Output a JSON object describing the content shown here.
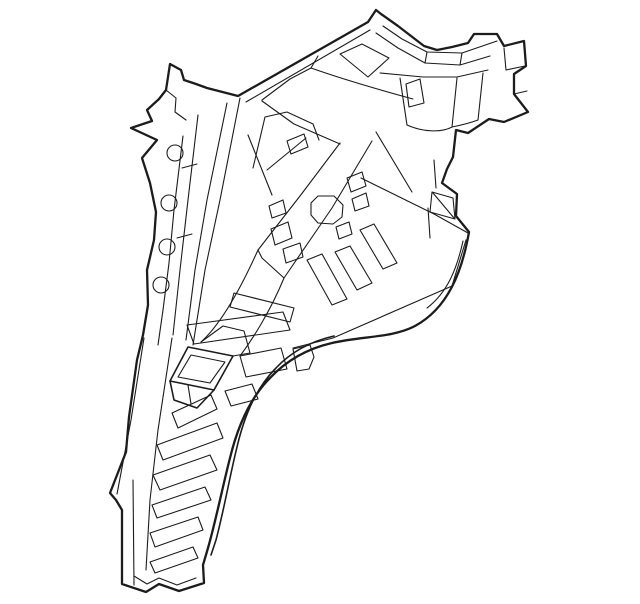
{
  "meta": {
    "alt_text": "Line drawing of an automotive inner quarter panel / pillar assembly",
    "canvas": {
      "width": 640,
      "height": 604
    },
    "background_color": "#ffffff",
    "stroke_color": "#1c1c1c",
    "stroke_widths": {
      "b": 2.3,
      "m": 1.6,
      "t": 1.1
    }
  },
  "illustration": {
    "paths": [
      {
        "d": "M170,64 L181,70 L184,80 L196,84 L207,88 L238,96 L368,22 L376,10 L381,14 L398,26 L424,46 L437,50 L452,47 L468,43 L474,34 L497,34 L504,46 L524,41 L526,66 L514,74 L514,94 L528,112 L504,122 L489,119 L468,133 L456,130 L453,157 L447,169 L442,183 L457,194 L456,216 L469,232 C462,272 448,308 415,326 C392,338 362,336 332,343 C306,349 285,362 270,378 C251,397 238,425 230,458 C223,485 216,520 208,548 L203,565 L204,583 L179,591 L159,584 L146,592 L122,584 L122,510 L116,500 L110,493 L126,452 L129,417 L137,360 L143,335 L148,305 L147,270 L154,240 L156,212 L150,183 L142,158 L157,140 L131,128 L152,121 L147,110 L159,99 L166,90 Z",
        "w": "b"
      },
      {
        "d": "M334,336 C308,342 290,353 276,368 C257,387 245,413 237,447 C230,475 224,510 216,540 L211,555",
        "w": "m"
      },
      {
        "d": "M463,241 C457,268 448,292 427,308",
        "w": "t"
      },
      {
        "d": "M293,348 L333,338 L452,286 L466,240",
        "w": "t"
      },
      {
        "d": "M246,102 L370,30",
        "w": "t"
      },
      {
        "d": "M318,56 L311,68",
        "w": "t"
      },
      {
        "d": "M311,68 C345,80 380,90 413,99",
        "w": "t"
      },
      {
        "d": "M383,26 L402,39 L427,52 L462,53 L497,41",
        "w": "t"
      },
      {
        "d": "M376,33 L398,48 L425,63 L460,65 L490,56",
        "w": "t"
      },
      {
        "d": "M427,52 L425,63",
        "w": "t"
      },
      {
        "d": "M462,53 L460,65",
        "w": "t"
      },
      {
        "d": "M380,73 L423,77 L457,77 L488,70",
        "w": "t"
      },
      {
        "d": "M504,48 L506,70 L525,66",
        "w": "t"
      },
      {
        "d": "M514,94 L527,91",
        "w": "t"
      },
      {
        "d": "M340,54 L362,44 L389,58 L368,77 Z",
        "w": "t"
      },
      {
        "d": "M262,100 L290,79 L311,68",
        "w": "t"
      },
      {
        "d": "M262,101 L294,124 L340,144",
        "w": "t"
      },
      {
        "d": "M406,84 L420,79 L424,103 L409,107 Z",
        "w": "t"
      },
      {
        "d": "M400,78 L407,125",
        "w": "t"
      },
      {
        "d": "M457,78 L452,127",
        "w": "t"
      },
      {
        "d": "M483,73 L478,120",
        "w": "t"
      },
      {
        "d": "M407,125 C425,133 443,132 452,127",
        "w": "t"
      },
      {
        "d": "M452,127 C462,125 470,123 478,120",
        "w": "t"
      },
      {
        "d": "M434,160 L436,188",
        "w": "t"
      },
      {
        "d": "M432,192 L453,198 L455,219 L430,212 Z",
        "w": "t"
      },
      {
        "d": "M433,193 L454,218",
        "w": "t"
      },
      {
        "d": "M428,208 L430,238",
        "w": "t"
      },
      {
        "d": "M376,132 L412,192",
        "w": "t"
      },
      {
        "d": "M361,178 L434,214 L468,233",
        "w": "t"
      },
      {
        "d": "M340,143 L300,196 L258,250",
        "w": "t"
      },
      {
        "d": "M372,141 L332,208 L284,278",
        "w": "t"
      },
      {
        "d": "M258,250 L262,258 L284,278",
        "w": "t"
      },
      {
        "d": "M258,250 C240,290 220,325 201,342",
        "w": "t"
      },
      {
        "d": "M284,278 C270,312 252,340 240,356",
        "w": "t"
      },
      {
        "d": "M253,168 L265,117 L287,112 L313,124 L319,140",
        "w": "t"
      },
      {
        "d": "M267,170 L306,138",
        "w": "t"
      },
      {
        "d": "M248,135 L272,195",
        "w": "t"
      },
      {
        "d": "M166,90 L176,98 L175,112 L186,120",
        "w": "t"
      },
      {
        "d": "M183,136 L174,210 L169,263 L163,310 L158,345",
        "w": "t"
      },
      {
        "d": "M198,115 L188,200 L180,270 L173,335",
        "w": "t"
      },
      {
        "d": "M227,103 L207,200 L195,270 L186,340",
        "w": "t"
      },
      {
        "d": "M240,98 L220,200 L205,270 L193,345",
        "w": "t"
      },
      {
        "d": "M182,168 L197,164",
        "w": "t"
      },
      {
        "d": "M177,238 L192,234",
        "w": "t"
      },
      {
        "d": "M144,338 L131,420 L117,494",
        "w": "t"
      },
      {
        "d": "M133,480 L134,585",
        "w": "t"
      },
      {
        "d": "M172,338 L158,430 L150,500 L146,570",
        "w": "t"
      },
      {
        "d": "M134,576 L147,584 L159,578 L177,585 L196,578",
        "w": "t"
      },
      {
        "d": "M172,413 L211,395 L217,409 L178,428 Z",
        "w": "t"
      },
      {
        "d": "M157,445 L217,423 L223,438 L163,460 Z",
        "w": "t"
      },
      {
        "d": "M153,475 L210,455 L217,470 L160,490 Z",
        "w": "t"
      },
      {
        "d": "M152,505 L205,487 L211,500 L157,518 Z",
        "w": "t"
      },
      {
        "d": "M150,533 L198,517 L203,530 L155,547 Z",
        "w": "t"
      },
      {
        "d": "M150,562 L193,547 L198,558 L155,573 Z",
        "w": "t"
      },
      {
        "d": "M187,325 L283,312 L290,330 L194,344 Z",
        "w": "t"
      },
      {
        "d": "M234,293 L294,308 L290,322 L230,307 Z",
        "w": "t"
      },
      {
        "d": "M240,356 L281,348 L287,369 L246,377 Z",
        "w": "t"
      },
      {
        "d": "M225,391 L252,384 L258,399 L231,406 Z",
        "w": "t"
      },
      {
        "d": "M170,381 L188,347 L233,356 L214,390 Z",
        "w": "m"
      },
      {
        "d": "M178,377 L191,355 L225,362 L210,383 Z",
        "w": "t"
      },
      {
        "d": "M170,381 L174,400 L197,408 L214,390",
        "w": "m"
      },
      {
        "d": "M188,385 L191,404",
        "w": "t"
      },
      {
        "d": "M201,342 L223,326 L244,331",
        "w": "t"
      },
      {
        "d": "M244,331 L250,353 L233,356",
        "w": "t"
      },
      {
        "d": "M318,196 L334,196 L343,205 L342,217 L333,224 L318,223 L311,215 L311,203 Z",
        "w": "t"
      },
      {
        "d": "M347,178 L362,172 L366,186 L351,192 Z",
        "w": "t"
      },
      {
        "d": "M352,199 L366,193 L369,206 L355,211 Z",
        "w": "t"
      },
      {
        "d": "M336,227 L349,222 L352,234 L339,239 Z",
        "w": "t"
      },
      {
        "d": "M269,206 L283,200 L286,213 L272,218 Z",
        "w": "t"
      },
      {
        "d": "M271,229 L288,222 L292,238 L275,245 Z",
        "w": "t"
      },
      {
        "d": "M283,249 L300,243 L303,257 L286,263 Z",
        "w": "t"
      },
      {
        "d": "M287,141 L304,134 L308,147 L291,154 Z",
        "w": "t"
      },
      {
        "d": "M307,260 L322,254 L347,299 L332,305 Z",
        "w": "t"
      },
      {
        "d": "M335,252 L350,246 L372,283 L357,290 Z",
        "w": "t"
      },
      {
        "d": "M360,230 L374,224 L397,263 L383,269 Z",
        "w": "t"
      },
      {
        "d": "M293,349 L310,345 L314,357 L309,369 L297,371 Z",
        "w": "t"
      }
    ],
    "circles": [
      {
        "cx": 175,
        "cy": 153,
        "r": 8
      },
      {
        "cx": 169,
        "cy": 203,
        "r": 8
      },
      {
        "cx": 167,
        "cy": 247,
        "r": 8
      },
      {
        "cx": 161,
        "cy": 285,
        "r": 8
      }
    ]
  }
}
